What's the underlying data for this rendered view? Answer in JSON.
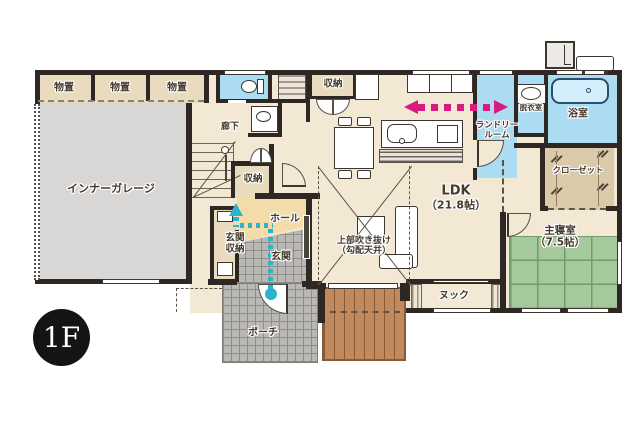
{
  "badge": {
    "label": "1F"
  },
  "colors": {
    "wall": "#2e2723",
    "floor": "#f2e8d4",
    "storage": "#e8dbbe",
    "garage": "#d8d7d5",
    "wet": "#abdcf2",
    "tub": "#d5eefb",
    "tatami": "#a5c99c",
    "tatami_line": "#6e9d68",
    "deck": "#c18a5e",
    "deck_line": "#8a5a34",
    "tile": "#b9b8b5",
    "tile_line": "#8f8e8b",
    "hall_floor": "#f3dca9",
    "closet_floor": "#dbcaa9",
    "pink": "#d81b7d",
    "teal": "#2ab4cd",
    "text": "#46392e",
    "badge_bg": "#141414"
  },
  "rooms": {
    "storage1": {
      "label": "物置"
    },
    "storage2": {
      "label": "物置"
    },
    "storage3": {
      "label": "物置"
    },
    "garage": {
      "label": "インナーガレージ"
    },
    "corridor": {
      "label": "廊下"
    },
    "stair_storage": {
      "label": "収納"
    },
    "top_storage": {
      "label": "収納"
    },
    "laundry": {
      "line1": "ランドリー",
      "line2": "ルーム"
    },
    "dressing": {
      "label": "脱衣室"
    },
    "bath": {
      "label": "浴室"
    },
    "closet": {
      "label": "クローゼット"
    },
    "ldk": {
      "label": "LDK",
      "size": "（21.8帖）"
    },
    "void": {
      "line1": "上部吹き抜け",
      "line2": "（勾配天井）"
    },
    "bedroom": {
      "label": "主寝室",
      "size": "（7.5帖）"
    },
    "nook": {
      "label": "ヌック"
    },
    "hall": {
      "label": "ホール"
    },
    "entrance": {
      "label": "玄関"
    },
    "entrance_storage": {
      "line1": "玄関",
      "line2": "収納"
    },
    "porch": {
      "label": "ポーチ"
    }
  }
}
